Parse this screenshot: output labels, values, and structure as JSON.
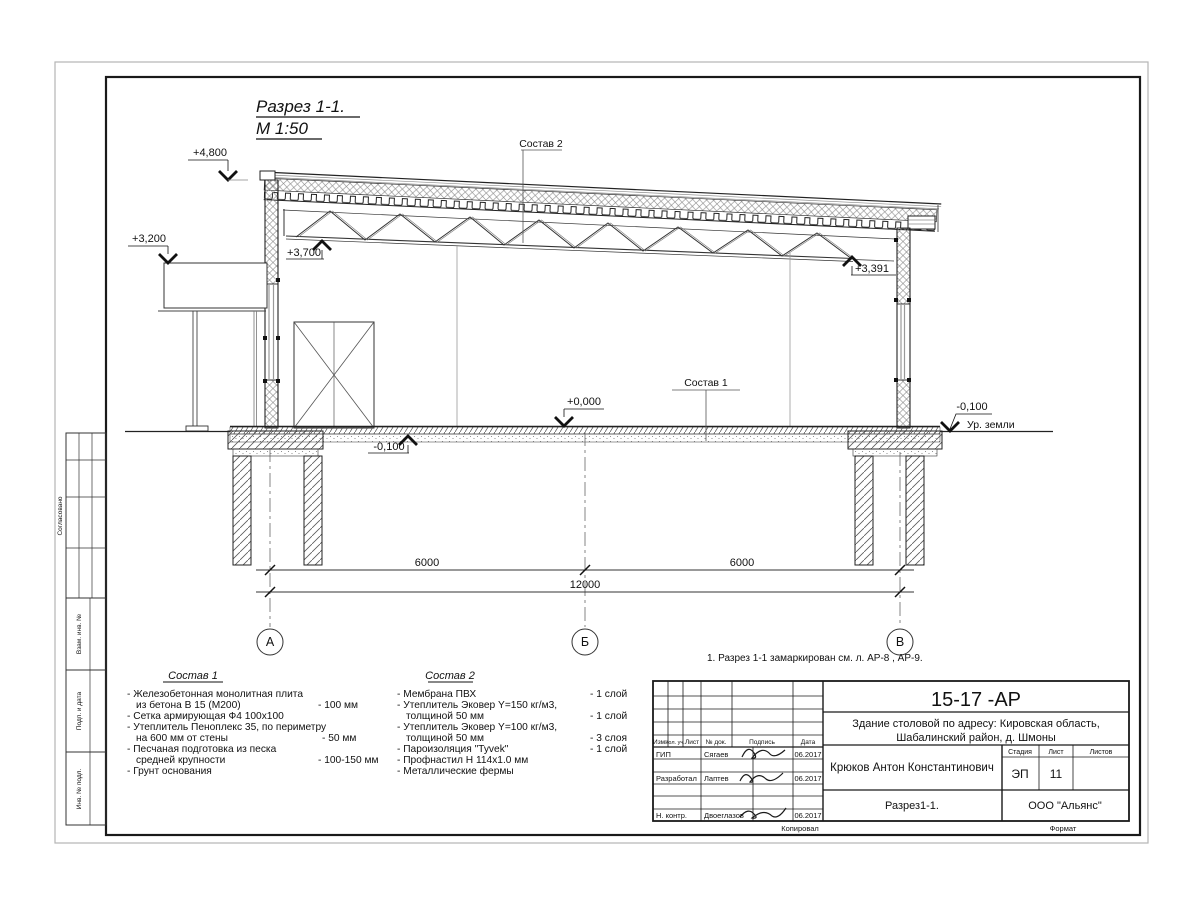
{
  "drawing": {
    "title": "Разрез 1-1.",
    "scale_label": "М 1:50",
    "elevations": {
      "e4800": "+4,800",
      "e3200": "+3,200",
      "e3700": "+3,700",
      "e3391": "+3,391",
      "e0000": "+0,000",
      "m100_left": "-0,100",
      "m100_right": "-0,100"
    },
    "ground_label": "Ур. земли",
    "callout1": "Состав 1",
    "callout2": "Состав 2",
    "dims": {
      "d1": "6000",
      "d2": "6000",
      "total": "12000"
    },
    "axes": {
      "a": "А",
      "b": "Б",
      "v": "В"
    },
    "note": "1. Разрез 1-1 замаркирован см. л. АР-8 , АР-9."
  },
  "sostav1": {
    "heading": "Состав 1",
    "lines": [
      {
        "t": "- Железобетонная  монолитная плита",
        "v": ""
      },
      {
        "t": "из бетона В 15 (М200)",
        "v": "- 100 мм"
      },
      {
        "t": "- Сетка армирующая Ф4 100х100",
        "v": ""
      },
      {
        "t": "- Утеплитель Пеноплекс 35, по периметру",
        "v": ""
      },
      {
        "t": "на 600 мм от стены",
        "v": "- 50 мм"
      },
      {
        "t": "- Песчаная подготовка из песка",
        "v": ""
      },
      {
        "t": "средней крупности",
        "v": "- 100-150 мм"
      },
      {
        "t": "- Грунт основания",
        "v": ""
      }
    ]
  },
  "sostav2": {
    "heading": "Состав 2",
    "lines": [
      {
        "t": "- Мембрана ПВХ",
        "v": "- 1 слой"
      },
      {
        "t": "- Утеплитель Эковер Y=150 кг/м3,",
        "v": ""
      },
      {
        "t": "толщиной 50 мм",
        "v": "- 1 слой"
      },
      {
        "t": "- Утеплитель Эковер Y=100 кг/м3,",
        "v": ""
      },
      {
        "t": "толщиной 50 мм",
        "v": "- 3 слоя"
      },
      {
        "t": "- Пароизоляция \"Tyvek\"",
        "v": "- 1 слой"
      },
      {
        "t": "- Профнастил Н 114х1.0 мм",
        "v": ""
      },
      {
        "t": "- Металлические фермы",
        "v": ""
      }
    ]
  },
  "titleblock": {
    "code": "15-17 -АР",
    "object_line1": "Здание столовой по адресу: Кировская область,",
    "object_line2": "Шабалинский район, д. Шмоны",
    "author": "Крюков Антон Константинович",
    "stage_label": "Стадия",
    "sheet_label": "Лист",
    "sheets_label": "Листов",
    "stage": "ЭП",
    "sheet": "11",
    "sheet_title": "Разрез1-1.",
    "company": "ООО \"Альянс\"",
    "cols": {
      "izm": "Изм.",
      "kol": "Кол. уч.",
      "list": "Лист",
      "doc": "№ док.",
      "sign": "Подпись",
      "date": "Дата"
    },
    "rows": [
      {
        "role": "ГИП",
        "name": "Сягаев",
        "date": "06.2017"
      },
      {
        "role": "Разработал",
        "name": "Лаптев",
        "date": "06.2017"
      },
      {
        "role": "Н. контр.",
        "name": "Двоеглазов",
        "date": "06.2017"
      }
    ],
    "copied_label": "Копировал",
    "format_label": "Формат"
  },
  "side_stamps": {
    "agreed": "Согласовано",
    "vzam": "Взам. инв. №",
    "podp": "Подп. и дата",
    "inv": "Инв. № подл."
  }
}
